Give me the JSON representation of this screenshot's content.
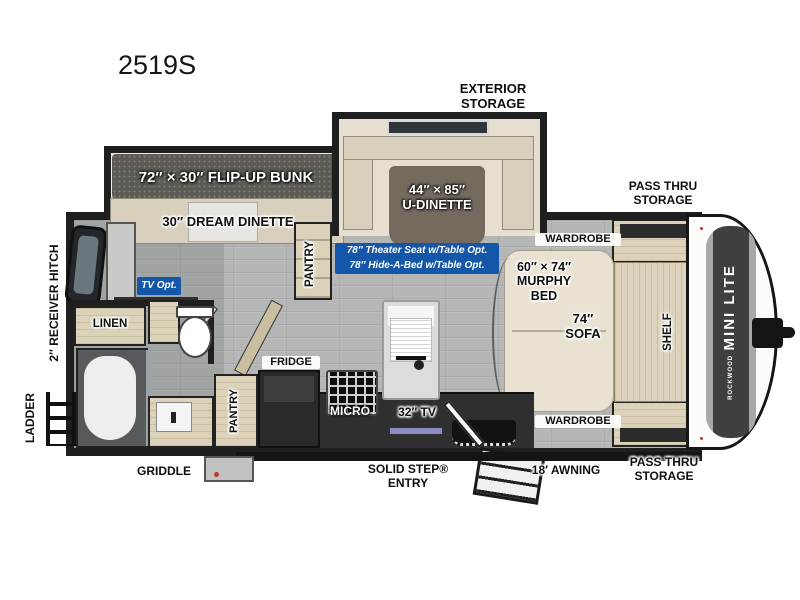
{
  "model": "2519S",
  "colors": {
    "wall": "#1f1f1f",
    "floor_gray": "#b4b7b6",
    "accent_blue": "#1457a8",
    "wood": "#dcd2ba",
    "bench_cream": "#d8d0bd",
    "bunk_dark": "#5d5954",
    "table_brown": "#756a5e",
    "front_cap_white": "#fbfbfb"
  },
  "exterior_labels": {
    "exterior_storage": "EXTERIOR\nSTORAGE",
    "pass_thru_storage_top": "PASS THRU\nSTORAGE",
    "pass_thru_storage_bottom": "PASS THRU\nSTORAGE",
    "awning": "18′ AWNING",
    "solid_step_entry": "SOLID STEP®\nENTRY",
    "griddle": "GRIDDLE",
    "ladder": "LADDER",
    "receiver_hitch": "2″ RECEIVER HITCH",
    "brand_small": "ROCKWOOD",
    "brand_large": "MINI LITE"
  },
  "interior_labels": {
    "flip_up_bunk": "72″ × 30″ FLIP-UP BUNK",
    "dream_dinette": "30″ DREAM DINETTE",
    "u_dinette": "44″ × 85″\nU-DINETTE",
    "options": "78″ Theater Seat w/Table Opt.\n78″ Hide-A-Bed w/Table Opt.",
    "tv_opt": "TV Opt.",
    "wardrobe_top": "WARDROBE",
    "wardrobe_bottom": "WARDROBE",
    "murphy_bed": "60″ × 74″\nMURPHY\nBED",
    "sofa": "74″\nSOFA",
    "shelf": "SHELF",
    "pantry_front": "PANTRY",
    "pantry_kitchen": "PANTRY",
    "fridge": "FRIDGE",
    "micro": "MICRO",
    "tv_32": "32″ TV",
    "linen": "LINEN"
  }
}
